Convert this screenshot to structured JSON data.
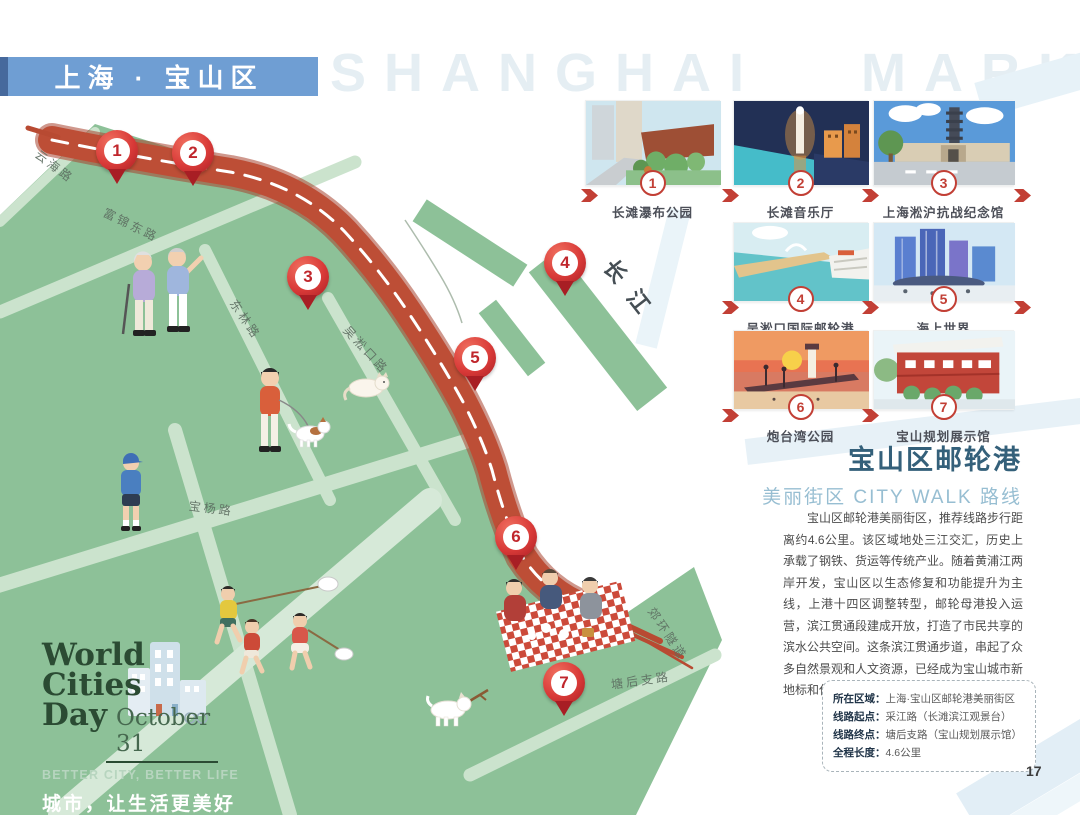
{
  "page": {
    "watermark": "SHANGHAI MARK",
    "number": "17"
  },
  "banner": {
    "title": "上海 · 宝山区"
  },
  "map": {
    "river_label": "长江",
    "pins": [
      {
        "number": "1"
      },
      {
        "number": "2"
      },
      {
        "number": "3"
      },
      {
        "number": "4"
      },
      {
        "number": "5"
      },
      {
        "number": "6"
      },
      {
        "number": "7"
      }
    ],
    "roads": [
      {
        "text": "云海路"
      },
      {
        "text": "富锦东路"
      },
      {
        "text": "东林路"
      },
      {
        "text": "吴淞口路"
      },
      {
        "text": "宝杨路"
      },
      {
        "text": "塘后支路"
      },
      {
        "text": "郊环隧道"
      }
    ]
  },
  "spots": [
    {
      "number": "1",
      "label": "长滩瀑布公园"
    },
    {
      "number": "2",
      "label": "长滩音乐厅"
    },
    {
      "number": "3",
      "label": "上海淞沪抗战纪念馆"
    },
    {
      "number": "4",
      "label": "吴淞口国际邮轮港"
    },
    {
      "number": "5",
      "label": "海上世界"
    },
    {
      "number": "6",
      "label": "炮台湾公园"
    },
    {
      "number": "7",
      "label": "宝山规划展示馆"
    }
  ],
  "article": {
    "title": "宝山区邮轮港",
    "subtitle": "美丽街区 CITY WALK 路线",
    "body": "宝山区邮轮港美丽街区，推荐线路步行距离约4.6公里。该区域地处三江交汇，历史上承载了钢铁、货运等传统产业。随着黄浦江两岸开发，宝山区以生态修复和功能提升为主线，上港十四区调整转型，邮轮母港投入运营，滨江贯通段建成开放，打造了市民共享的滨水公共空间。这条滨江贯通步道，串起了众多自然景观和人文资源，已经成为宝山城市新地标和休闲好去处。"
  },
  "info_box": {
    "rows": [
      {
        "label": "所在区域：",
        "value": "上海·宝山区邮轮港美丽街区"
      },
      {
        "label": "线路起点：",
        "value": "采江路（长滩滨江观景台）"
      },
      {
        "label": "线路终点：",
        "value": "塘后支路（宝山规划展示馆）"
      },
      {
        "label": "全程长度：",
        "value": "4.6公里"
      }
    ]
  },
  "logo": {
    "line1": "World",
    "line2": "Cities",
    "line3": "Day",
    "date": "October 31",
    "slogan_en": "BETTER CITY, BETTER LIFE",
    "slogan_cn": "城市，让生活更美好"
  },
  "colors": {
    "banner_blue": "#6f9ed3",
    "map_green": "#8dc198",
    "route_red": "#bd4e36",
    "accent_red": "#c23f35",
    "title_blue": "#34607a",
    "subtitle_blue": "#97bed2",
    "logo_green": "#2b4b33"
  }
}
